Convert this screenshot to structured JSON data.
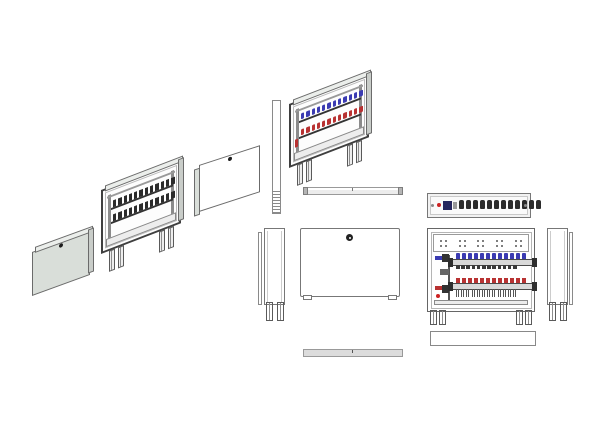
{
  "colors": {
    "background": "#ffffff",
    "line": "#6b6b6b",
    "line_dark": "#3f3f3f",
    "panel_fill": "#d9ded9",
    "panel_light": "#ebeeeb",
    "valve_dark": "#2b2b2b",
    "flow_blue": "#3b3bb2",
    "return_red": "#b83232",
    "indicator_red": "#cc2222",
    "module_navy": "#26265e"
  },
  "components": {
    "iso_cover_filled": {
      "lock_screws": 1
    },
    "iso_cabinet_open": {
      "loops": 12,
      "leg_pairs": 2
    },
    "iso_cover_outline": {
      "lock_screws": 1
    },
    "iso_cabinet_assembled": {
      "loops": 12,
      "leg_pairs": 2
    },
    "top_rail": {
      "end_caps": 2
    },
    "wiring_rail": {
      "terminals": 12
    },
    "side_view_left": {
      "legs": 2
    },
    "front_cover": {
      "lock_screws": 1,
      "feet": 2
    },
    "front_cabinet": {
      "loops": 12,
      "knockout_groups": 5,
      "leg_pairs": 2
    },
    "side_view_right": {
      "legs": 2
    },
    "bottom_rail": {},
    "plinth": {}
  }
}
